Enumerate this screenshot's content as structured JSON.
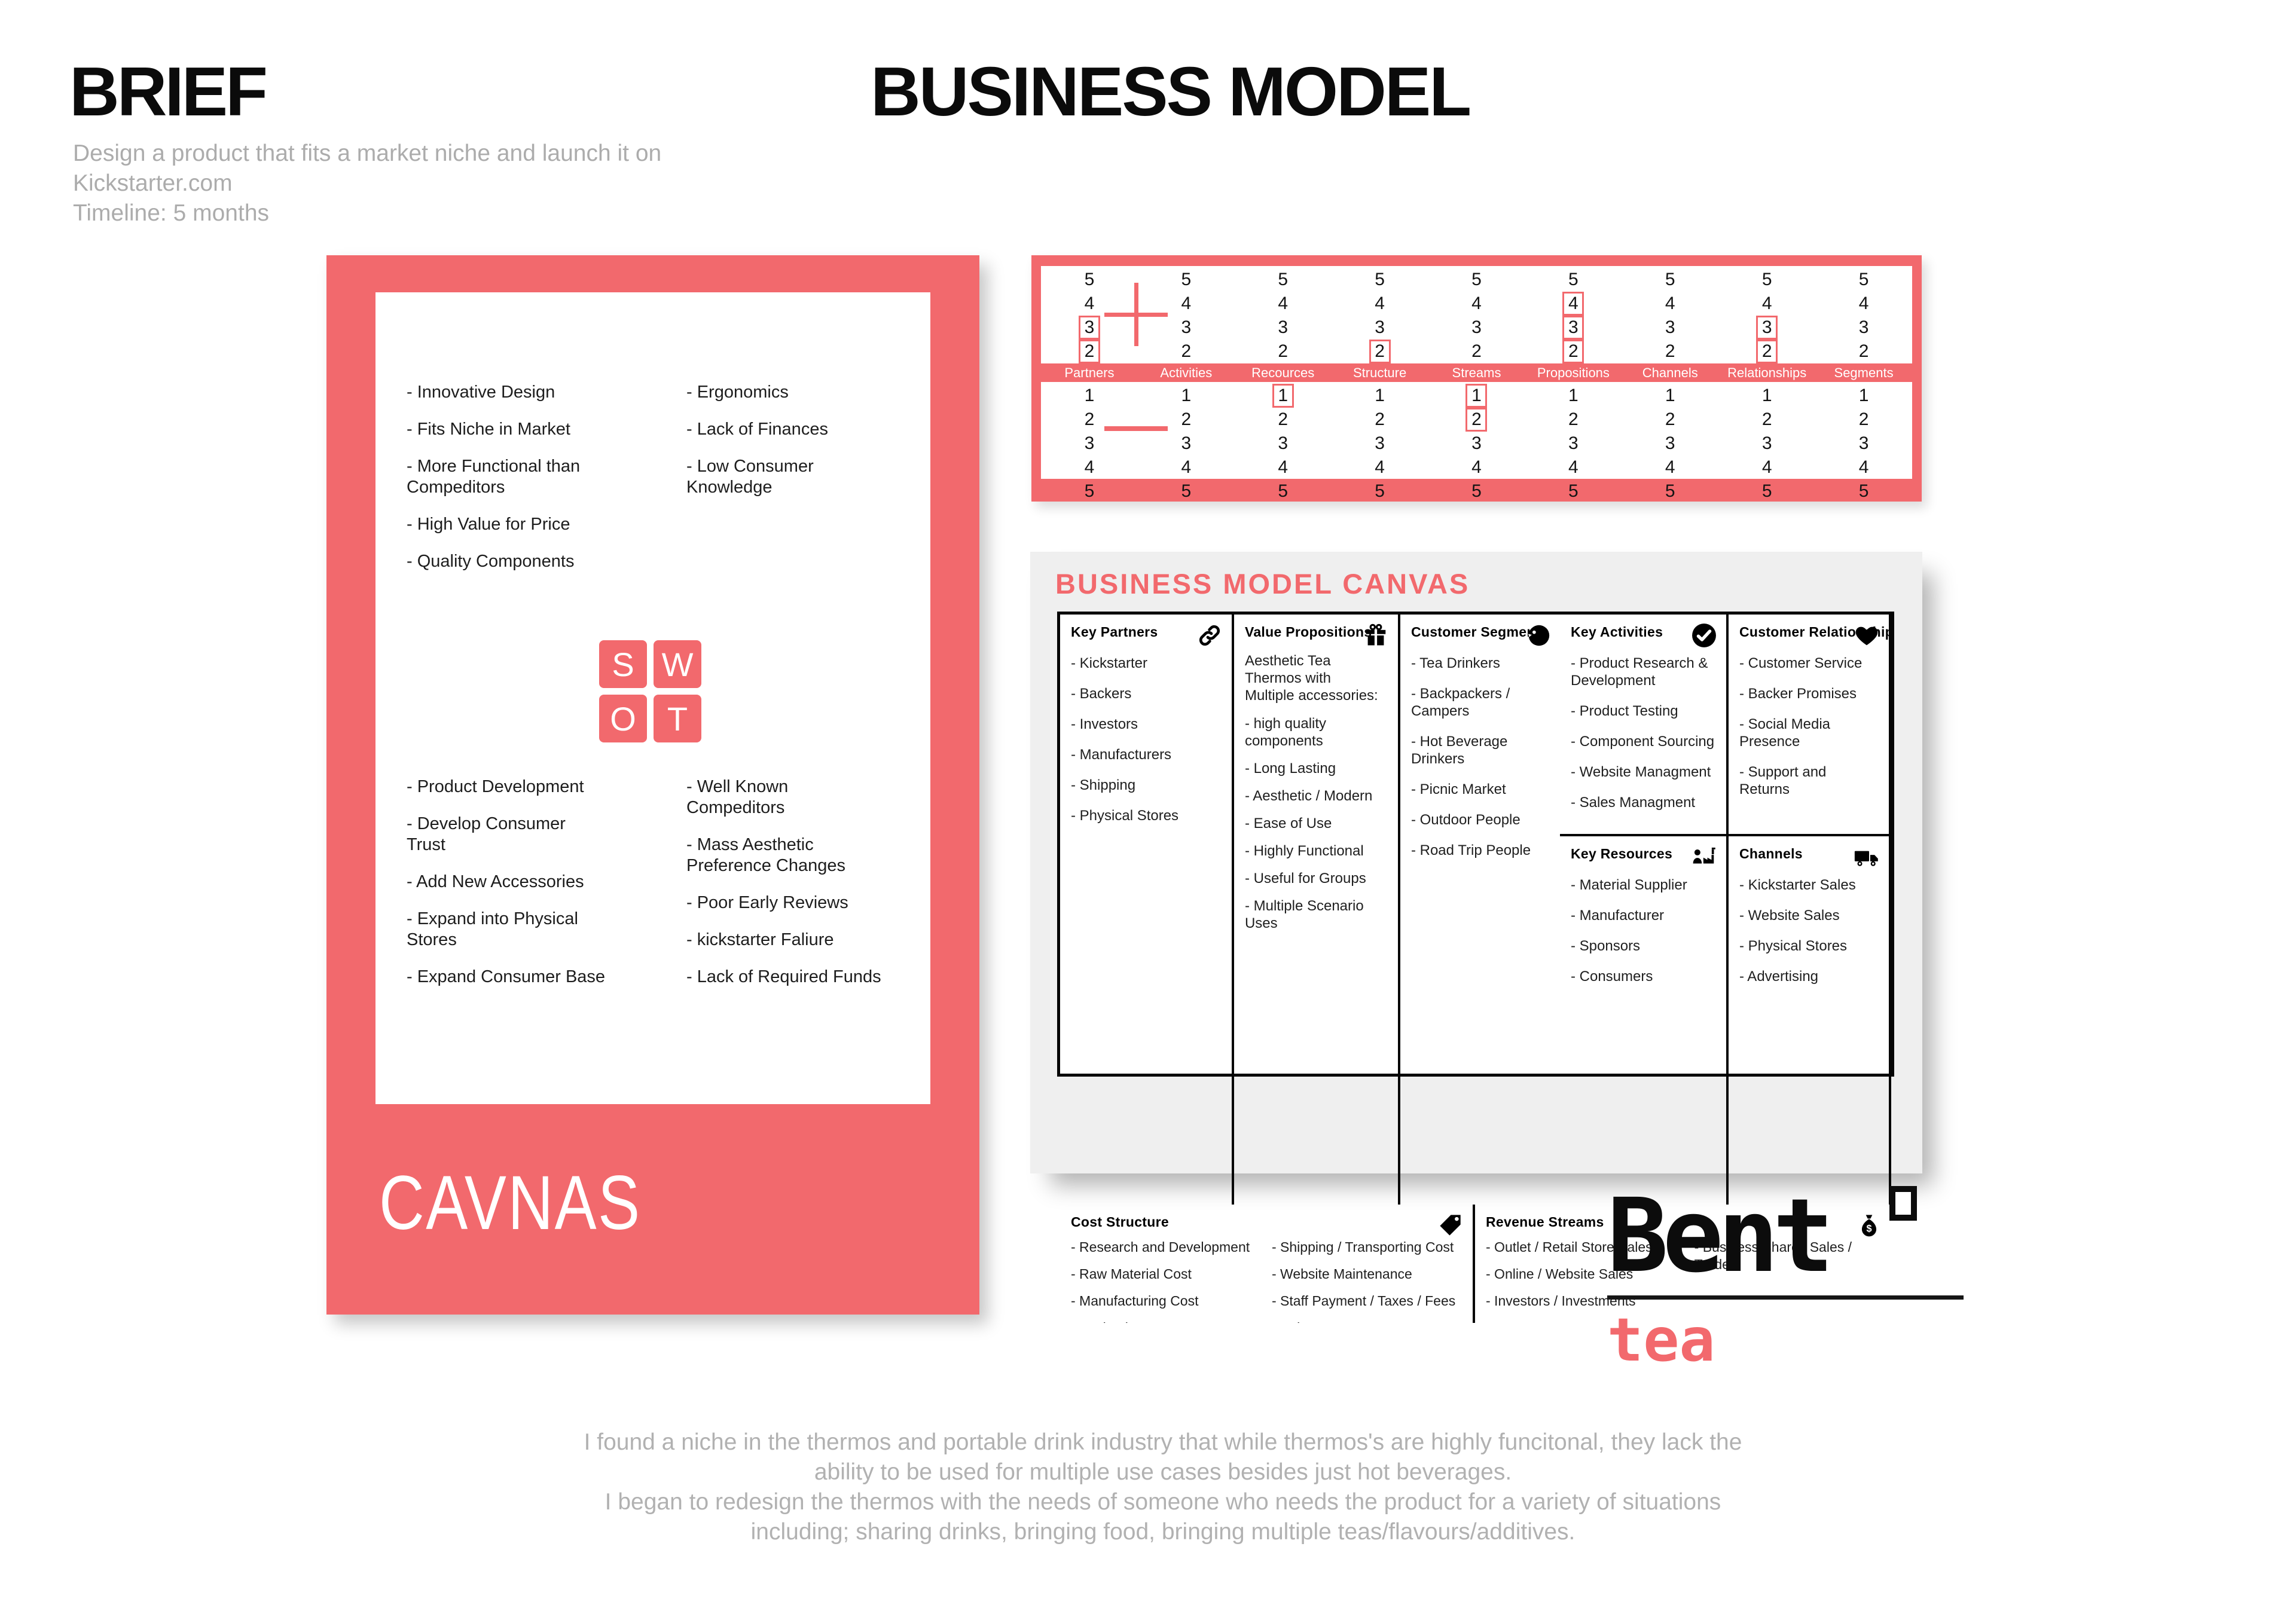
{
  "colors": {
    "coral": "#F2696D",
    "panel": "#EFEFEF",
    "muted": "#ACACAC",
    "ink": "#0B0B0B"
  },
  "brief": {
    "title": "BRIEF",
    "description": "Design a product that fits a market niche and launch it on\nKickstarter.com\nTimeline: 5 months"
  },
  "titles": {
    "business_model": "BUSINESS MODEL"
  },
  "swot": {
    "card_label": "CAVNAS",
    "letters": [
      "S",
      "W",
      "O",
      "T"
    ],
    "strengths": [
      "- Innovative Design",
      "- Fits Niche in Market",
      "- More Functional than\n  Compeditors",
      "- High Value for Price",
      "- Quality Components"
    ],
    "weaknesses": [
      "- Ergonomics",
      "- Lack of Finances",
      "- Low Consumer\n  Knowledge"
    ],
    "opportunities": [
      "- Product Development",
      "- Develop Consumer\n  Trust",
      "- Add New Accessories",
      "- Expand into Physical\n  Stores",
      "- Expand Consumer Base"
    ],
    "threats": [
      "- Well Known\n  Compeditors",
      "- Mass Aesthetic\n  Preference Changes",
      "- Poor Early Reviews",
      "- kickstarter Faliure",
      "- Lack of Required Funds"
    ]
  },
  "rating_grid": {
    "plus_symbol": "plus",
    "minus_symbol": "minus",
    "top_values": [
      5,
      4,
      3,
      2,
      1
    ],
    "bottom_values": [
      1,
      2,
      3,
      4,
      5
    ],
    "columns": [
      {
        "label": "Partners",
        "plus_boxed": [
          3,
          2,
          1
        ],
        "minus_boxed": []
      },
      {
        "label": "Activities",
        "plus_boxed": [
          1
        ],
        "minus_boxed": []
      },
      {
        "label": "Recources",
        "plus_boxed": [],
        "minus_boxed": [
          1
        ]
      },
      {
        "label": "Structure",
        "plus_boxed": [
          2,
          1
        ],
        "minus_boxed": []
      },
      {
        "label": "Streams",
        "plus_boxed": [],
        "minus_boxed": [
          1,
          2
        ]
      },
      {
        "label": "Propositions",
        "plus_boxed": [
          4,
          3,
          2,
          1
        ],
        "minus_boxed": []
      },
      {
        "label": "Channels",
        "plus_boxed": [
          1
        ],
        "minus_boxed": []
      },
      {
        "label": "Relationships",
        "plus_boxed": [
          3,
          2,
          1
        ],
        "minus_boxed": []
      },
      {
        "label": "Segments",
        "plus_boxed": [
          1
        ],
        "minus_boxed": []
      }
    ]
  },
  "bmc": {
    "title": "BUSINESS MODEL CANVAS",
    "key_partners": {
      "title": "Key Partners",
      "icon": "link-icon",
      "items": [
        "- Kickstarter",
        "- Backers",
        "- Investors",
        "- Manufacturers",
        "- Shipping",
        "- Physical Stores"
      ]
    },
    "key_activities": {
      "title": "Key Activities",
      "icon": "check-circle-icon",
      "items": [
        "- Product Research &\n  Development",
        "- Product Testing",
        "- Component Sourcing",
        "- Website Managment",
        "- Sales Managment"
      ]
    },
    "key_resources": {
      "title": "Key Resources",
      "icon": "person-factory-icon",
      "items": [
        "- Material Supplier",
        "- Manufacturer",
        "- Sponsors",
        "- Consumers"
      ]
    },
    "value_propositions": {
      "title": "Value Propositions",
      "icon": "gift-icon",
      "intro": "Aesthetic Tea Thermos with\nMultiple accessories:",
      "items": [
        "- high quality components",
        "- Long Lasting",
        "- Aesthetic / Modern",
        "- Ease of Use",
        "- Highly Functional",
        "- Useful for Groups",
        "- Multiple Scenario Uses"
      ]
    },
    "customer_relationships": {
      "title": "Customer Relationships",
      "icon": "heart-icon",
      "items": [
        "- Customer Service",
        "- Backer Promises",
        "- Social Media Presence",
        "- Support and Returns"
      ]
    },
    "channels": {
      "title": "Channels",
      "icon": "truck-icon",
      "items": [
        "- Kickstarter Sales",
        "- Website Sales",
        "- Physical Stores",
        "- Advertising"
      ]
    },
    "customer_segments": {
      "title": "Customer Segments",
      "icon": "head-icon",
      "items": [
        "- Tea Drinkers",
        "- Backpackers / Campers",
        "- Hot Beverage Drinkers",
        "- Picnic Market",
        "- Outdoor People",
        "- Road Trip People"
      ]
    },
    "cost_structure": {
      "title": "Cost Structure",
      "icon": "tag-icon",
      "col1": [
        "- Research and Development",
        "- Raw Material Cost",
        "- Manufacturing Cost",
        "- Packaging Cost"
      ],
      "col2": [
        "- Shipping / Transporting Cost",
        "- Website Maintenance",
        "- Staff Payment / Taxes / Fees",
        "- Sales"
      ]
    },
    "revenue_streams": {
      "title": "Revenue Streams",
      "icon": "money-bag-icon",
      "col1": [
        "- Outlet / Retail Store Sales",
        "- Online / Website Sales",
        "- Investors / Investments"
      ],
      "col2": [
        "- Business Shares Sales / Trade"
      ]
    }
  },
  "logo": {
    "name": "Bent",
    "sub": "tea"
  },
  "footer": {
    "paragraph": "I found a niche in the thermos and portable drink industry that while thermos's are highly funcitonal, they lack the\nability to be used for multiple use cases besides just hot beverages.\nI began to redesign the thermos with the needs of someone who needs the product for a variety of situations\nincluding; sharing drinks, bringing food, bringing multiple teas/flavours/additives."
  }
}
